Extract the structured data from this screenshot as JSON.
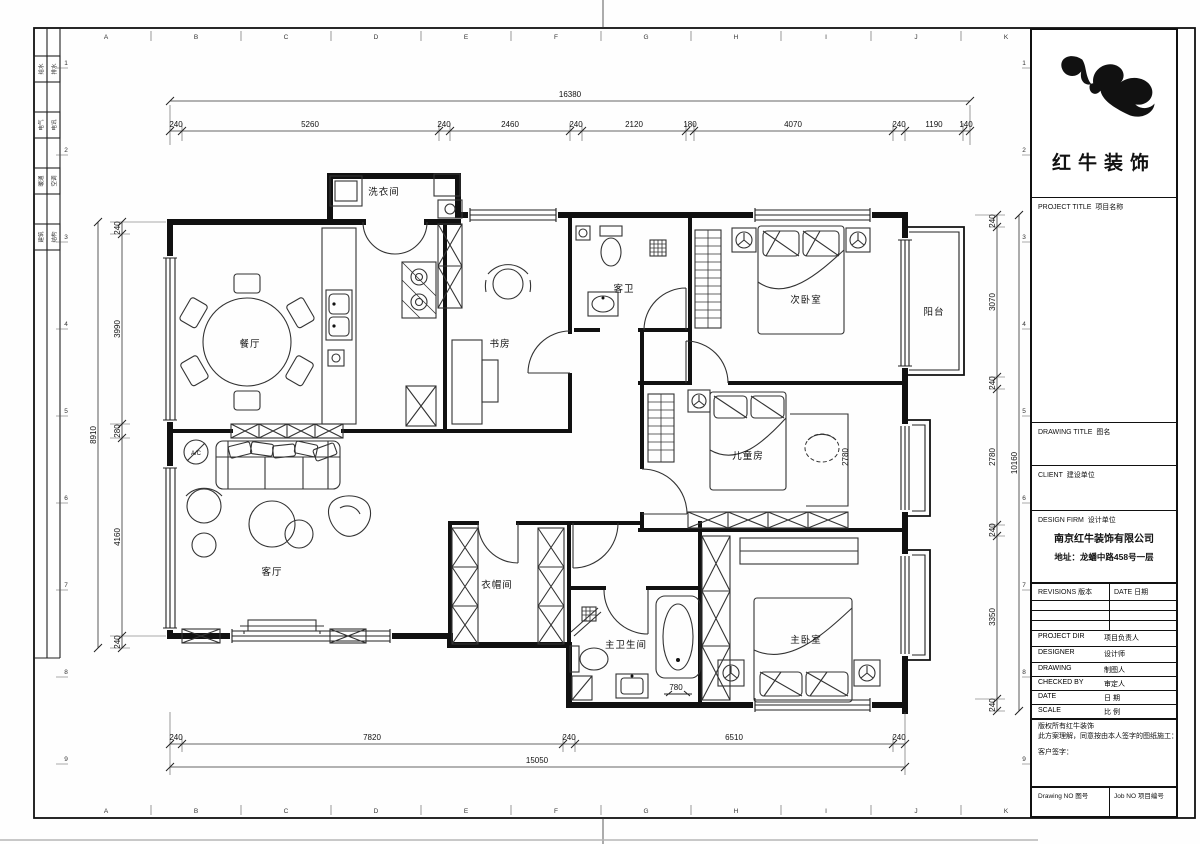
{
  "sheet": {
    "axes_cols": [
      "A",
      "B",
      "C",
      "D",
      "E",
      "F",
      "G",
      "H",
      "I",
      "J",
      "K"
    ],
    "axes_rows": [
      "1",
      "2",
      "3",
      "4",
      "5",
      "6",
      "7",
      "8",
      "9"
    ],
    "disciplines": [
      {
        "a": "给水",
        "b": "排水"
      },
      {
        "a": "电气",
        "b": "电讯"
      },
      {
        "a": "暖通",
        "b": "空调"
      },
      {
        "a": "建筑",
        "b": "结构"
      }
    ]
  },
  "rooms": {
    "laundry": "洗衣间",
    "dining": "餐厅",
    "study": "书房",
    "guest_bath": "客卫",
    "second_bedroom": "次卧室",
    "balcony": "阳台",
    "kids_room": "儿童房",
    "living": "客厅",
    "cloakroom": "衣帽间",
    "master_bath": "主卫生间",
    "master_bedroom": "主卧室",
    "ac": "A/C"
  },
  "dims": {
    "top_total": "16380",
    "top": [
      "240",
      "5260",
      "240",
      "2460",
      "240",
      "2120",
      "180",
      "4070",
      "240",
      "1190",
      "140"
    ],
    "left_total": "8910",
    "left": [
      "240",
      "3990",
      "280",
      "4160",
      "240"
    ],
    "right_total": "10160",
    "right": [
      "240",
      "3070",
      "240",
      "2780",
      "240",
      "3350",
      "240"
    ],
    "bottom_total": "15050",
    "bottom": [
      "240",
      "7820",
      "240",
      "6510",
      "240"
    ],
    "inner_kids": "2780",
    "inner_tub": "780"
  },
  "titleblock": {
    "brand": "红牛装饰",
    "project_title": "PROJECT TITLE",
    "project_title_cn": "项目名称",
    "drawing_title": "DRAWING TITLE",
    "drawing_title_cn": "图名",
    "client": "CLIENT",
    "client_cn": "建设单位",
    "design_firm": "DESIGN FIRM",
    "design_firm_cn": "设计单位",
    "firm_name": "南京红牛装饰有限公司",
    "firm_address": "地址：龙蟠中路458号一层",
    "revisions": "REVISIONS 版本",
    "date_col": "DATE 日期",
    "rows": [
      {
        "en": "PROJECT DIR",
        "cn": "项目负责人"
      },
      {
        "en": "DESIGNER",
        "cn": "设计师"
      },
      {
        "en": "DRAWING",
        "cn": "制图人"
      },
      {
        "en": "CHECKED BY",
        "cn": "审定人"
      },
      {
        "en": "DATE",
        "cn": "日  期"
      },
      {
        "en": "SCALE",
        "cn": "比  例"
      }
    ],
    "copyright1": "版权所有红牛装饰",
    "copyright2": "此方案理解，同意按由本人签字的图纸施工：",
    "signature": "客户签字：",
    "drawing_no": "Drawing NO 图号",
    "job_no": "Job NO 项目编号"
  }
}
